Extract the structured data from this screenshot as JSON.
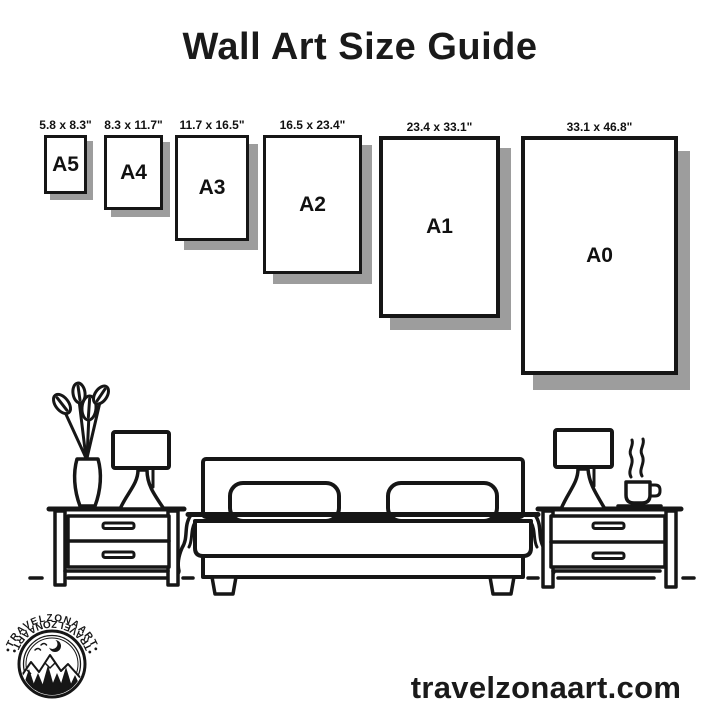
{
  "page": {
    "title": "Wall Art Size Guide",
    "website": "travelzonaart.com",
    "colors": {
      "background": "#ffffff",
      "ink": "#161616",
      "frame_shadow": "#9d9d9d"
    }
  },
  "size_guide": {
    "frames": [
      {
        "name": "A5",
        "size_label": "5.8 x 8.3\""
      },
      {
        "name": "A4",
        "size_label": "8.3 x 11.7\""
      },
      {
        "name": "A3",
        "size_label": "11.7 x 16.5\""
      },
      {
        "name": "A2",
        "size_label": "16.5 x 23.4\""
      },
      {
        "name": "A1",
        "size_label": "23.4 x 33.1\""
      },
      {
        "name": "A0",
        "size_label": "33.1 x 46.8\""
      }
    ]
  },
  "logo": {
    "arc_text_top": "•TRAVELZONAART•",
    "arc_text_bottom": "•TRAVELZONAART•"
  },
  "scene": {
    "icons": [
      "plant-vase-icon",
      "table-lamp-icon",
      "nightstand-icon",
      "double-bed-icon",
      "table-lamp-icon",
      "coffee-cup-icon",
      "nightstand-icon"
    ]
  }
}
